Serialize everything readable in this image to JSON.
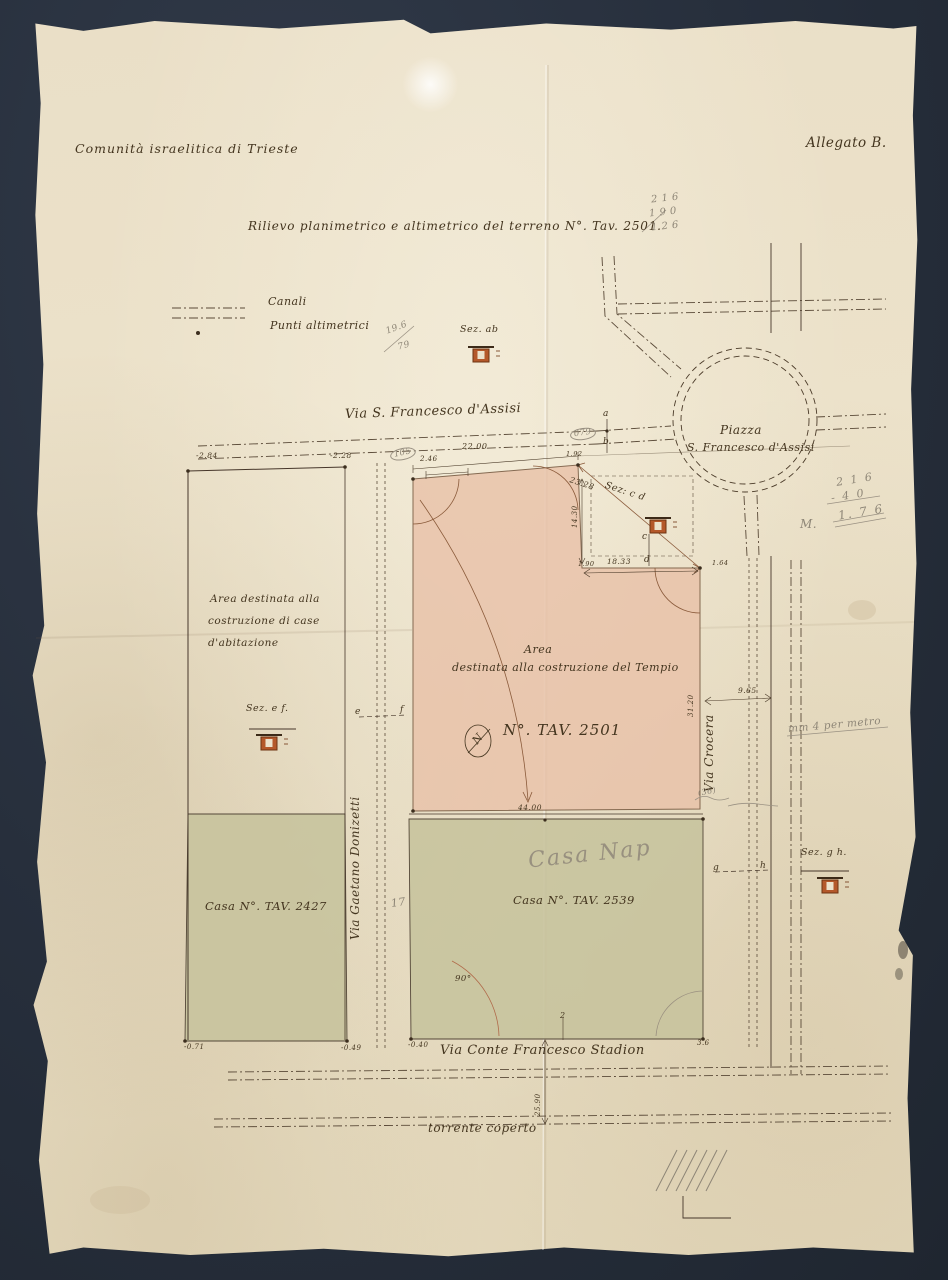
{
  "document": {
    "organization": "Comunità israelitica di Trieste",
    "attachment": "Allegato B.",
    "title": "Rilievo planimetrico e altimetrico del terreno N°. Tav. 2501."
  },
  "legend": {
    "canali": "Canali",
    "punti_altimetrici": "Punti altimetrici"
  },
  "streets": {
    "via_s_francesco": "Via S. Francesco d'Assisi",
    "piazza_line1": "Piazza",
    "piazza_line2": "S. Francesco d'Assisi",
    "via_gaetano_donizetti": "Via Gaetano Donizetti",
    "via_crocera": "Via Crocera",
    "via_conte_francesco_stadion": "Via Conte Francesco Stadion",
    "torrente_coperto": "torrente coperto"
  },
  "areas": {
    "case_abitazione_line1": "Area destinata alla",
    "case_abitazione_line2": "costruzione di case",
    "case_abitazione_line3": "d'abitazione",
    "tempio_line1": "Area",
    "tempio_line2": "destinata alla costruzione del Tempio",
    "tempio_number": "N°. TAV. 2501",
    "casa_2427": "Casa N°. TAV. 2427",
    "casa_2539": "Casa N°. TAV. 2539"
  },
  "sections": {
    "ab": "Sez. ab",
    "cd": "Sez: c d",
    "ef": "Sez. e f.",
    "gh": "Sez. g h.",
    "mark_a": "a",
    "mark_b": "b",
    "mark_c": "c",
    "mark_d": "d",
    "mark_e": "e",
    "mark_f": "f",
    "mark_g": "g",
    "mark_h": "h",
    "north": "N"
  },
  "measurements": {
    "top_width": "22.00",
    "offset_246": "2.46",
    "corner_192": "1.92",
    "notch_height": "14.30",
    "notch_bottom": "18.33",
    "diagonal": "23.28",
    "corner_190": "1.90",
    "corner_164": "1.64",
    "right_height": "31.20",
    "crocera_width": "9.65",
    "bottom_width": "44.00",
    "angle": "90°",
    "torrente_dist": "25.90",
    "pt_neg284": "-2.84",
    "pt_neg228": "-2.28",
    "pt_neg071": "-0.71",
    "pt_neg049": "-0.49",
    "pt_neg040": "-0.40",
    "pt_2": "2",
    "pt_36": "3.6"
  },
  "pencil_notes": {
    "calc1_line1": "2 1 6",
    "calc1_line2": "1 9 0",
    "calc1_line3": "1 2 6",
    "fraction_top": "19.6",
    "fraction_bottom": "79",
    "circled_105": "105",
    "circled_079": "079",
    "calc2_prefix": "M.",
    "calc2_line1": "2 1 6",
    "calc2_line2": "- 4 0",
    "calc2_line3": "1. 7 6",
    "scale_note": "mm 4 per metro",
    "note_36": "(36)",
    "casa_pencil": "Casa Nap",
    "num_17": "17"
  },
  "colors": {
    "backdrop": "#262e3b",
    "paper": "#e9dfc6",
    "ink": "#44351f",
    "pencil": "#8e8677",
    "tempio_fill": "#e9c2a9",
    "casa_fill": "#c8c49e",
    "terracotta": "#b4582a"
  }
}
